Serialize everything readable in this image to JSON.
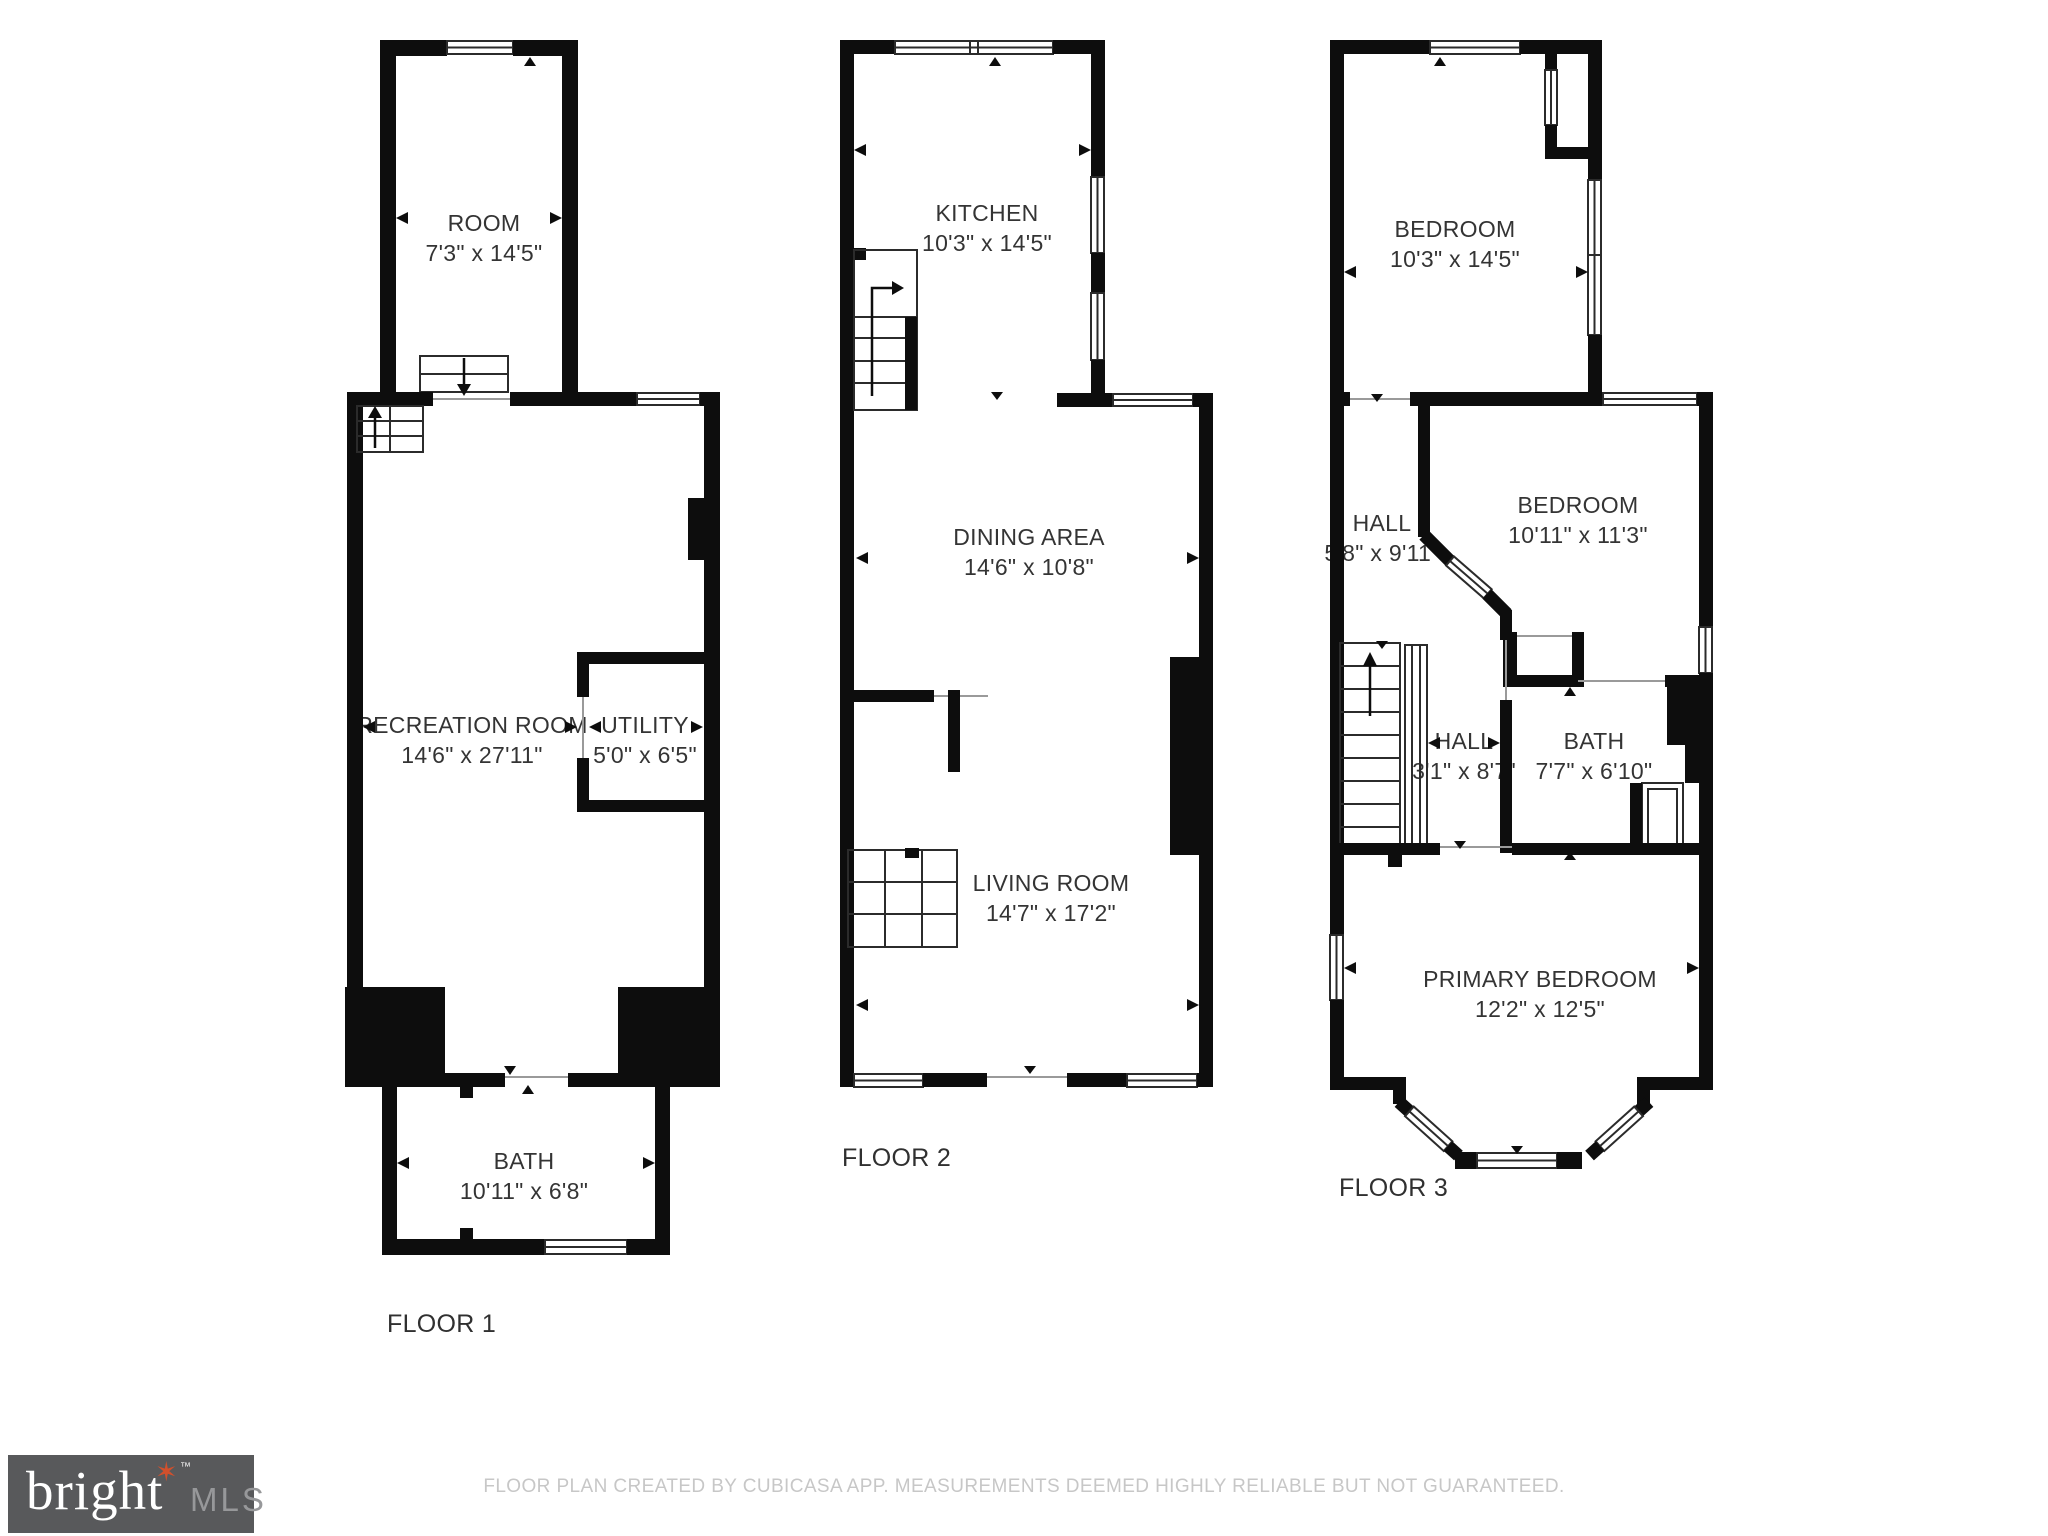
{
  "page": {
    "background": "#ffffff",
    "wall_color": "#0d0d0d",
    "label_color": "#343434"
  },
  "floors": [
    {
      "label": "FLOOR 1",
      "rooms": [
        {
          "name": "ROOM",
          "dims": "7'3\" x 14'5\""
        },
        {
          "name": "RECREATION ROOM",
          "dims": "14'6\" x 27'11\""
        },
        {
          "name": "UTILITY",
          "dims": "5'0\" x 6'5\""
        },
        {
          "name": "BATH",
          "dims": "10'11\" x 6'8\""
        }
      ]
    },
    {
      "label": "FLOOR 2",
      "rooms": [
        {
          "name": "KITCHEN",
          "dims": "10'3\" x 14'5\""
        },
        {
          "name": "DINING AREA",
          "dims": "14'6\" x 10'8\""
        },
        {
          "name": "LIVING ROOM",
          "dims": "14'7\" x 17'2\""
        }
      ]
    },
    {
      "label": "FLOOR 3",
      "rooms": [
        {
          "name": "BEDROOM",
          "dims": "10'3\" x 14'5\""
        },
        {
          "name": "HALL",
          "dims": "5'8\" x 9'11\""
        },
        {
          "name": "BEDROOM",
          "dims": "10'11\" x 11'3\""
        },
        {
          "name": "HALL",
          "dims": "3'1\" x 8'7\""
        },
        {
          "name": "BATH",
          "dims": "7'7\" x 6'10\""
        },
        {
          "name": "PRIMARY BEDROOM",
          "dims": "12'2\" x 12'5\""
        }
      ]
    }
  ],
  "footer": {
    "disclaimer": "FLOOR PLAN CREATED BY CUBICASA APP. MEASUREMENTS DEEMED HIGHLY RELIABLE BUT NOT GUARANTEED."
  },
  "logo": {
    "brand": "bright",
    "tm": "™",
    "suffix": "MLS",
    "star": "✶",
    "colors": {
      "background": "#58595b",
      "brand": "#ffffff",
      "star": "#d2502c",
      "suffix": "#97989a"
    }
  }
}
